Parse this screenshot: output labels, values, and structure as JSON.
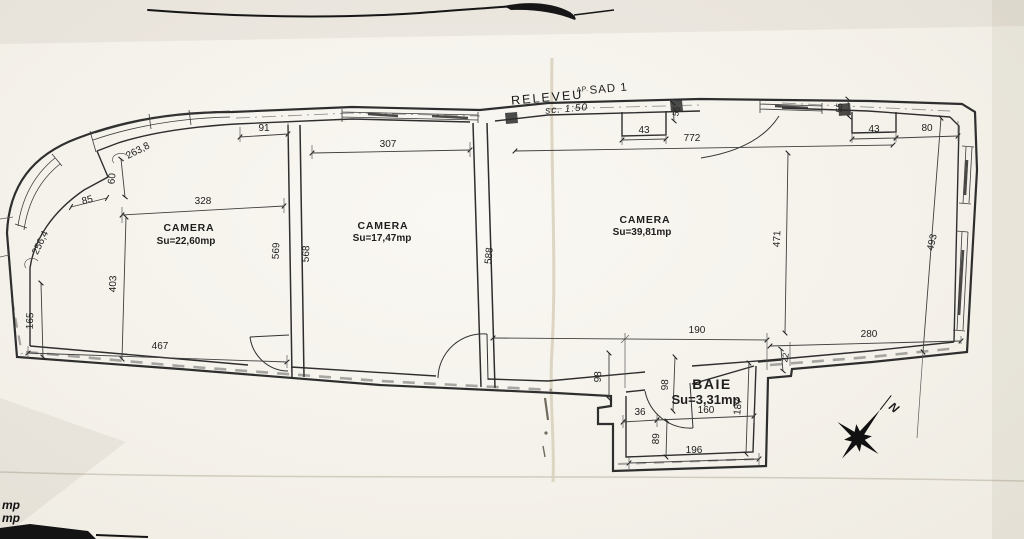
{
  "title": {
    "releveu": "RELEVEU",
    "ap": "AP.",
    "unit": "SAD 1",
    "scale": "sc. 1:50"
  },
  "rooms": {
    "camera1": {
      "name": "CAMERA",
      "area": "Su=22,60mp"
    },
    "camera2": {
      "name": "CAMERA",
      "area": "Su=17,47mp"
    },
    "camera3": {
      "name": "CAMERA",
      "area": "Su=39,81mp"
    },
    "baie": {
      "name": "BAIE",
      "area": "Su=3,31mp"
    }
  },
  "compass": {
    "north": "N"
  },
  "cutoff": {
    "line1": "mp",
    "line2": "mp"
  },
  "dims": {
    "d91": "91",
    "d263": "263,8",
    "d60": "60",
    "d85": "85",
    "d256": "256,4",
    "d328": "328",
    "d307": "307",
    "d772": "772",
    "d43_mid": "43",
    "d55_mid": "55",
    "d43_right": "43",
    "d80": "80",
    "d55_right": "55",
    "d569": "569",
    "d568": "568",
    "d588": "588",
    "d403": "403",
    "d165": "165",
    "d467": "467",
    "d471": "471",
    "d493": "493",
    "d190": "190",
    "d280": "280",
    "d22": "22",
    "d98_out": "98",
    "d98_in": "98",
    "d187": "187",
    "d36": "36",
    "d160": "160",
    "d89": "89",
    "d196": "196"
  },
  "colors": {
    "ink": "#2e2e2e",
    "paper": "#f5f2ec",
    "crease": "#d9d1bd"
  }
}
